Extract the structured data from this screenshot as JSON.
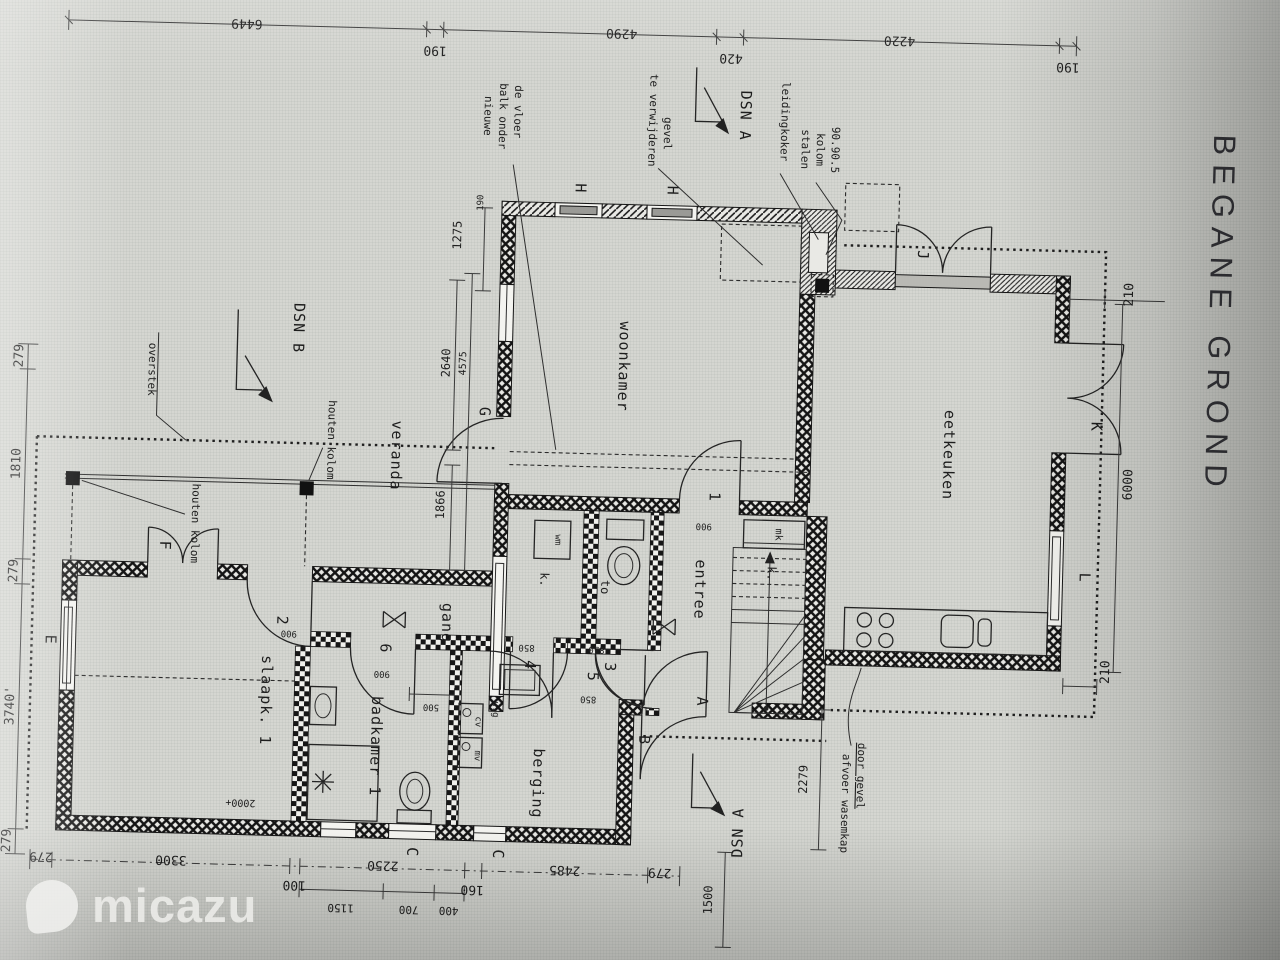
{
  "watermark": {
    "brand": "micazu"
  },
  "title": {
    "text": "BEGANE GROND"
  },
  "rooms": {
    "woonkamer": "woonkamer",
    "eetkeuken": "eetkeuken",
    "veranda": "veranda",
    "gang": "gang",
    "entree": "entree",
    "berging": "berging",
    "slaapk": "slaapk. 1",
    "badkamer": "badkamer 1",
    "kast1": "k.",
    "kast2": "k.",
    "toilet": "to",
    "mk": "mk",
    "wm": "wm",
    "ug": "u.g",
    "cv": "cv",
    "mv": "mv"
  },
  "annotations": {
    "overstek": "overstek",
    "houten_kolom": "houten kolom",
    "nieuwe_balk_1": "nieuwe",
    "nieuwe_balk_2": "balk onder",
    "nieuwe_balk_3": "de vloer",
    "te_verwijderen_1": "te verwijderen",
    "te_verwijderen_2": "gevel",
    "leidingkoker": "leidingkoker",
    "stalen_1": "stalen",
    "stalen_2": "kolom",
    "stalen_3": "90.90.5",
    "afvoer_1": "afvoer wasemkap",
    "afvoer_2": "door gevel",
    "dsn_a": "DSN A",
    "dsn_b": "DSN B"
  },
  "markers": {
    "A": "A",
    "B": "B",
    "C": "C",
    "E": "E",
    "F": "F",
    "G": "G",
    "H": "H",
    "J": "J",
    "K": "K",
    "L": "L",
    "d1": "1",
    "d2": "2",
    "d3": "3",
    "d4": "4",
    "d5": "5",
    "d6": "6"
  },
  "dims": {
    "top": [
      "6449",
      "190",
      "4290",
      "420",
      "4220",
      "190"
    ],
    "left": [
      "279",
      "1810",
      "279",
      "3740'",
      "279"
    ],
    "bottom": [
      "279",
      "3300",
      "100",
      "2250",
      "160",
      "2485",
      "279"
    ],
    "bottom_sub": [
      "1150",
      "700",
      "400"
    ],
    "right": [
      "210",
      "6000",
      "210"
    ],
    "inner": [
      "1275",
      "190",
      "2640",
      "4575",
      "1866",
      "900",
      "900",
      "900",
      "850",
      "850",
      "850",
      "500",
      "2279",
      "1500",
      "2000+"
    ]
  }
}
